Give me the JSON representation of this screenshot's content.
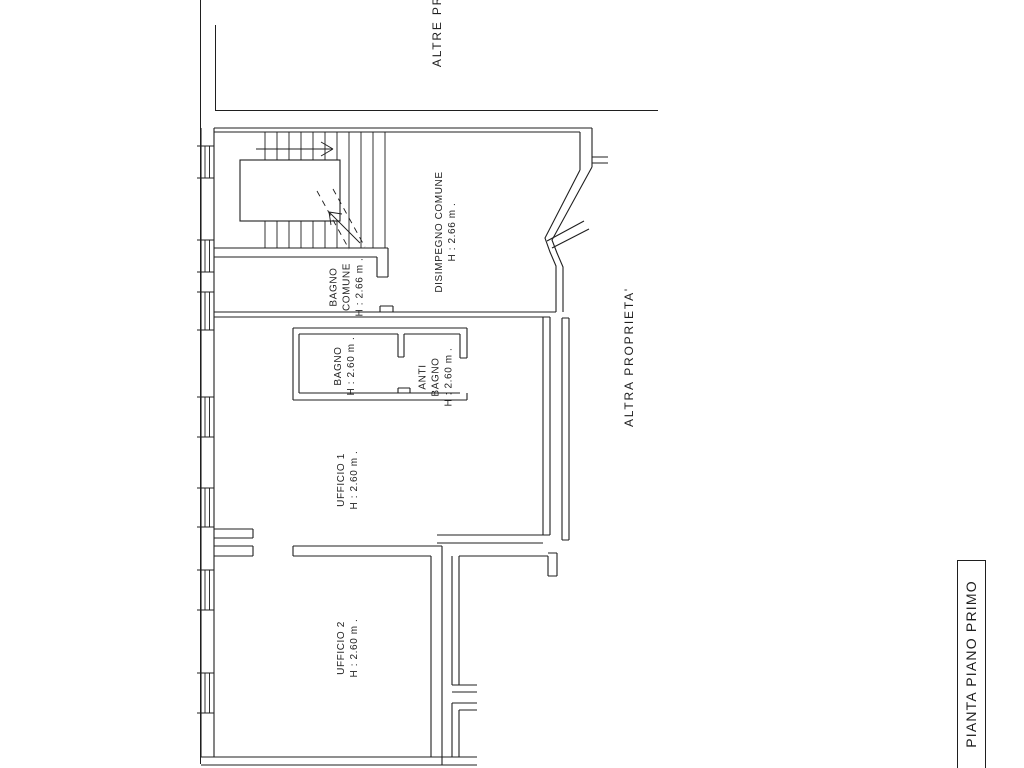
{
  "page": {
    "background": "#ffffff",
    "ink": "#1f1f1f",
    "kind": "architectural floor plan"
  },
  "title_block": {
    "text": "PIANTA PIANO PRIMO"
  },
  "boundaries": {
    "top": "ALTRE PR",
    "right": "ALTRA PROPRIETA'"
  },
  "rooms": [
    {
      "id": "bagno-comune",
      "line1": "BAGNO",
      "line2": "COMUNE",
      "height": "H : 2.66 m ."
    },
    {
      "id": "disimpegno-comune",
      "line1": "DISIMPEGNO COMUNE",
      "height": "H : 2.66 m ."
    },
    {
      "id": "bagno",
      "line1": "BAGNO",
      "height": "H : 2.60 m ."
    },
    {
      "id": "anti-bagno",
      "line1": "ANTI",
      "line2": "BAGNO",
      "height": "H : 2.60 m ."
    },
    {
      "id": "ufficio-1",
      "line1": "UFFICIO 1",
      "height": "H : 2.60 m ."
    },
    {
      "id": "ufficio-2",
      "line1": "UFFICIO 2",
      "height": "H : 2.60 m ."
    }
  ]
}
